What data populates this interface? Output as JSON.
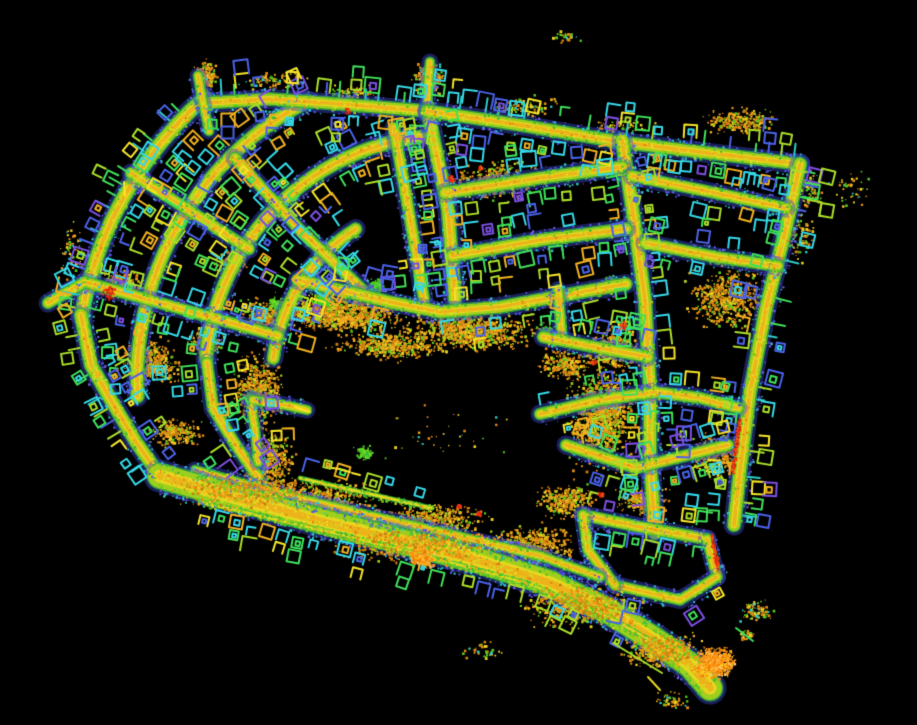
{
  "meta": {
    "label": "lidar-point-cloud-neighborhood-map",
    "width": 917,
    "height": 725,
    "background": "#000000",
    "seed": 1337
  },
  "palette": {
    "road": {
      "edge": "#3a46cc",
      "green": "#2fae3f",
      "mid": "#9ccf1e",
      "center": "#e6d81f",
      "hot": "#f0a418",
      "thin": [
        "#38b93c",
        "#aade28",
        "#e6d81f"
      ]
    },
    "speckle": {
      "edge": [
        "#4553d8",
        "#2fc8c8",
        "#6a5ae0"
      ],
      "mid": [
        "#38b93c",
        "#a8d21f",
        "#58c81e"
      ],
      "core": [
        "#e6d81f",
        "#f0b020",
        "#e08a14",
        "#cde01f",
        "#e6d81f",
        "#cde01f"
      ]
    },
    "houses": [
      [
        "#35d8e8",
        20
      ],
      [
        "#3fe05a",
        22
      ],
      [
        "#aade28",
        18
      ],
      [
        "#4a62e8",
        15
      ],
      [
        "#f0b020",
        12
      ],
      [
        "#f5e428",
        8
      ],
      [
        "#7a4fe0",
        5
      ]
    ],
    "ticks": [
      [
        "#3fe05a",
        30
      ],
      [
        "#2fc8c8",
        25
      ],
      [
        "#4a62e8",
        20
      ],
      [
        "#aade28",
        25
      ]
    ],
    "clusters": {
      "veg": [
        [
          "#e08a14",
          30
        ],
        [
          "#f5a81c",
          20
        ],
        [
          "#c27a10",
          14
        ],
        [
          "#f0d020",
          14
        ],
        [
          "#a8cc20",
          11
        ],
        [
          "#58c81e",
          11
        ]
      ],
      "blob": [
        [
          "#ff9414",
          30
        ],
        [
          "#ffae1c",
          25
        ],
        [
          "#f07c0a",
          25
        ],
        [
          "#ffd020",
          10
        ],
        [
          "#ffc96a",
          10
        ]
      ],
      "sparse": [
        [
          "#e08a14",
          30
        ],
        [
          "#f0d020",
          25
        ],
        [
          "#58c81e",
          25
        ],
        [
          "#2fc8c8",
          10
        ],
        [
          "#f5a81c",
          10
        ]
      ],
      "green": [
        [
          "#40d22a",
          30
        ],
        [
          "#58c81e",
          30
        ],
        [
          "#7de022",
          25
        ],
        [
          "#2fae3f",
          15
        ]
      ]
    },
    "red": [
      [
        "#e02810",
        35
      ],
      [
        "#ff3c14",
        30
      ],
      [
        "#c01c08",
        20
      ],
      [
        "#f06a10",
        15
      ]
    ],
    "mark_yellow": "#ffe428",
    "stray_colors": [
      "#aade28",
      "#e6d81f",
      "#3fe05a"
    ]
  },
  "map": {
    "arc_center": [
      450,
      380
    ],
    "arcs": [
      {
        "r": 374,
        "a0": -170,
        "a1": -131,
        "w": 13,
        "ticks": 1,
        "houses": 2
      },
      {
        "r": 313,
        "a0": -183,
        "a1": -117,
        "w": 12,
        "ticks": 0,
        "houses": 2
      },
      {
        "r": 245,
        "a0": -175,
        "a1": -95,
        "w": 12,
        "ticks": 0,
        "houses": 2
      },
      {
        "r": 178,
        "a0": -173,
        "a1": -120,
        "w": 11,
        "ticks": 0,
        "houses": 2
      }
    ],
    "streets": [
      {
        "pts": [
          [
            203,
            103
          ],
          [
            270,
            99
          ],
          [
            340,
            104
          ],
          [
            427,
            111
          ]
        ],
        "w": 11,
        "ticks": 1,
        "houses": 2
      },
      {
        "pts": [
          [
            209,
            131
          ],
          [
            202,
            98
          ],
          [
            198,
            76
          ]
        ],
        "w": 8,
        "houses": 0
      },
      {
        "pts": [
          [
            427,
            111
          ],
          [
            428,
            85
          ],
          [
            430,
            62
          ]
        ],
        "w": 8,
        "houses": 0
      },
      {
        "pts": [
          [
            81,
            315
          ],
          [
            91,
            365
          ],
          [
            112,
            402
          ],
          [
            136,
            442
          ],
          [
            160,
            476
          ]
        ],
        "w": 12,
        "ticks": -1,
        "houses": 2
      },
      {
        "pts": [
          [
            249,
            249
          ],
          [
            131,
            173
          ]
        ],
        "w": 10,
        "houses": 2
      },
      {
        "pts": [
          [
            365,
            292
          ],
          [
            300,
            230
          ],
          [
            235,
            158
          ]
        ],
        "w": 10,
        "houses": 2
      },
      {
        "pts": [
          [
            278,
            336
          ],
          [
            85,
            282
          ],
          [
            48,
            303
          ]
        ],
        "w": 10,
        "houses": 2
      },
      {
        "pts": [
          [
            207,
            363
          ],
          [
            213,
            408
          ],
          [
            235,
            444
          ],
          [
            258,
            477
          ]
        ],
        "w": 10,
        "houses": 2
      },
      {
        "pts": [
          [
            250,
            398
          ],
          [
            255,
            430
          ],
          [
            258,
            462
          ]
        ],
        "w": 8,
        "houses": 2
      },
      {
        "pts": [
          [
            253,
            400
          ],
          [
            280,
            404
          ],
          [
            307,
            410
          ]
        ],
        "w": 8,
        "houses": 0
      },
      {
        "pts": [
          [
            394,
            128
          ],
          [
            410,
            218
          ],
          [
            424,
            300
          ]
        ],
        "w": 10,
        "houses": 2
      },
      {
        "pts": [
          [
            428,
            112
          ],
          [
            448,
            210
          ],
          [
            455,
            300
          ]
        ],
        "w": 12,
        "houses": 2
      },
      {
        "pts": [
          [
            427,
            111
          ],
          [
            520,
            125
          ],
          [
            620,
            142
          ],
          [
            700,
            152
          ],
          [
            800,
            164
          ]
        ],
        "w": 11,
        "ticks": 1,
        "houses": 2
      },
      {
        "pts": [
          [
            800,
            164
          ],
          [
            786,
            228
          ],
          [
            766,
            308
          ],
          [
            750,
            392
          ],
          [
            740,
            470
          ],
          [
            734,
            525
          ]
        ],
        "w": 12,
        "ticks": 1,
        "houses": 2
      },
      {
        "pts": [
          [
            622,
            140
          ],
          [
            634,
            220
          ],
          [
            645,
            300
          ],
          [
            650,
            390
          ],
          [
            650,
            460
          ],
          [
            655,
            533
          ]
        ],
        "w": 12,
        "houses": 2
      },
      {
        "pts": [
          [
            445,
            193
          ],
          [
            540,
            178
          ],
          [
            622,
            167
          ]
        ],
        "w": 11,
        "houses": 2
      },
      {
        "pts": [
          [
            632,
            176
          ],
          [
            706,
            191
          ],
          [
            786,
            208
          ]
        ],
        "w": 10,
        "houses": 2
      },
      {
        "pts": [
          [
            452,
            256
          ],
          [
            540,
            240
          ],
          [
            626,
            229
          ]
        ],
        "w": 11,
        "houses": 2
      },
      {
        "pts": [
          [
            645,
            243
          ],
          [
            716,
            257
          ],
          [
            778,
            266
          ]
        ],
        "w": 10,
        "houses": 2
      },
      {
        "pts": [
          [
            298,
            280
          ],
          [
            340,
            290
          ],
          [
            390,
            302
          ],
          [
            440,
            312
          ],
          [
            500,
            307
          ],
          [
            560,
            296
          ],
          [
            626,
            284
          ]
        ],
        "w": 11,
        "houses": 2
      },
      {
        "pts": [
          [
            558,
            290
          ],
          [
            562,
            338
          ]
        ],
        "w": 9,
        "houses": 0
      },
      {
        "pts": [
          [
            543,
            337
          ],
          [
            600,
            348
          ],
          [
            648,
            357
          ]
        ],
        "w": 10,
        "houses": 1
      },
      {
        "pts": [
          [
            540,
            414
          ],
          [
            600,
            400
          ],
          [
            655,
            392
          ],
          [
            700,
            398
          ],
          [
            738,
            408
          ]
        ],
        "w": 10,
        "houses": 2
      },
      {
        "pts": [
          [
            566,
            445
          ],
          [
            636,
            468
          ],
          [
            700,
            452
          ],
          [
            728,
            445
          ]
        ],
        "w": 10,
        "houses": 2
      },
      {
        "pts": [
          [
            583,
            515
          ],
          [
            640,
            527
          ],
          [
            707,
            539
          ]
        ],
        "w": 10,
        "houses": 2
      },
      {
        "pts": [
          [
            707,
            539
          ],
          [
            717,
            577
          ]
        ],
        "w": 9,
        "houses": 0
      },
      {
        "pts": [
          [
            717,
            577
          ],
          [
            680,
            600
          ],
          [
            615,
            585
          ]
        ],
        "w": 9,
        "houses": 1
      },
      {
        "pts": [
          [
            615,
            585
          ],
          [
            588,
            550
          ],
          [
            583,
            515
          ]
        ],
        "w": 9,
        "houses": 0
      },
      {
        "pts": [
          [
            195,
            470
          ],
          [
            280,
            494
          ],
          [
            380,
            518
          ],
          [
            470,
            539
          ],
          [
            540,
            556
          ],
          [
            600,
            577
          ]
        ],
        "w": 8,
        "houses": 0
      },
      {
        "pts": [
          [
            160,
            476
          ],
          [
            240,
            499
          ],
          [
            320,
            521
          ],
          [
            400,
            541
          ],
          [
            480,
            561
          ],
          [
            550,
            583
          ],
          [
            610,
            612
          ],
          [
            655,
            640
          ],
          [
            690,
            665
          ],
          [
            710,
            688
          ]
        ],
        "w": 24,
        "houses": 0,
        "sp": 2.5
      },
      {
        "pts": [
          [
            200,
            502
          ],
          [
            265,
            517
          ],
          [
            330,
            532
          ],
          [
            395,
            548
          ],
          [
            460,
            565
          ],
          [
            530,
            584
          ],
          [
            590,
            610
          ]
        ],
        "w": 3,
        "houses": -1,
        "hd": 1.3
      },
      {
        "pts": [
          [
            560,
            595
          ],
          [
            610,
            618
          ],
          [
            650,
            640
          ],
          [
            680,
            658
          ]
        ],
        "w": 3,
        "houses": -1,
        "hd": 1.2
      },
      {
        "pts": [
          [
            300,
            478
          ],
          [
            370,
            494
          ],
          [
            432,
            508
          ]
        ],
        "w": 3,
        "houses": 1,
        "hd": 1.2
      }
    ],
    "clusters": [
      [
        340,
        313,
        72,
        22,
        1150
      ],
      [
        470,
        330,
        70,
        20,
        900
      ],
      [
        258,
        390,
        25,
        40,
        560
      ],
      [
        268,
        462,
        28,
        32,
        430
      ],
      [
        600,
        420,
        34,
        52,
        900
      ],
      [
        612,
        348,
        30,
        24,
        420
      ],
      [
        320,
        500,
        60,
        22,
        520
      ],
      [
        430,
        520,
        60,
        20,
        470
      ],
      [
        530,
        545,
        50,
        20,
        520
      ],
      [
        495,
        180,
        45,
        20,
        420
      ],
      [
        725,
        297,
        42,
        32,
        600
      ],
      [
        565,
        363,
        26,
        16,
        240
      ],
      [
        718,
        455,
        33,
        24,
        330
      ],
      [
        640,
        500,
        28,
        16,
        240
      ],
      [
        565,
        500,
        32,
        20,
        330
      ],
      [
        150,
        362,
        34,
        24,
        420
      ],
      [
        265,
        315,
        32,
        18,
        300
      ],
      [
        120,
        282,
        22,
        15,
        200
      ],
      [
        175,
        432,
        28,
        16,
        240
      ],
      [
        230,
        262,
        18,
        12,
        150
      ],
      [
        205,
        340,
        20,
        14,
        170
      ],
      [
        605,
        400,
        35,
        25,
        450
      ],
      [
        740,
        120,
        38,
        14,
        260
      ],
      [
        205,
        75,
        13,
        16,
        230
      ],
      [
        427,
        80,
        15,
        18,
        260
      ],
      [
        390,
        345,
        60,
        15,
        450,
        "veg",
        1
      ],
      [
        250,
        490,
        80,
        20,
        500,
        "veg",
        1
      ],
      [
        420,
        545,
        90,
        20,
        550,
        "veg",
        1
      ],
      [
        580,
        605,
        60,
        22,
        600,
        "veg",
        1
      ],
      [
        660,
        650,
        40,
        18,
        500,
        "veg",
        1
      ],
      [
        714,
        662,
        20,
        16,
        650,
        "blob",
        1
      ],
      [
        420,
        558,
        14,
        10,
        180,
        "blob",
        1
      ],
      [
        70,
        250,
        14,
        30,
        60,
        "sparse"
      ],
      [
        565,
        35,
        14,
        8,
        25,
        "sparse"
      ],
      [
        800,
        235,
        15,
        28,
        90,
        "sparse"
      ],
      [
        850,
        190,
        22,
        20,
        40,
        "sparse"
      ],
      [
        480,
        650,
        25,
        10,
        35,
        "sparse"
      ],
      [
        672,
        700,
        22,
        10,
        60,
        "sparse"
      ],
      [
        745,
        635,
        10,
        8,
        30,
        "sparse"
      ],
      [
        810,
        190,
        12,
        20,
        70,
        "sparse"
      ],
      [
        270,
        80,
        40,
        10,
        90,
        "sparse"
      ],
      [
        350,
        92,
        30,
        8,
        70,
        "sparse"
      ],
      [
        520,
        105,
        40,
        10,
        80,
        "sparse"
      ],
      [
        620,
        125,
        40,
        10,
        80,
        "sparse"
      ],
      [
        755,
        610,
        18,
        12,
        80,
        "sparse"
      ],
      [
        440,
        430,
        80,
        40,
        35,
        "sparse"
      ],
      [
        322,
        298,
        12,
        10,
        160,
        "green"
      ],
      [
        375,
        286,
        10,
        8,
        120,
        "green"
      ],
      [
        545,
        332,
        9,
        8,
        100,
        "green"
      ],
      [
        275,
        303,
        9,
        7,
        90,
        "green"
      ],
      [
        363,
        452,
        10,
        8,
        90,
        "green"
      ],
      [
        608,
        282,
        9,
        7,
        80,
        "green"
      ]
    ],
    "red_spots": [
      [
        108,
        292,
        9
      ],
      [
        347,
        110,
        4
      ],
      [
        450,
        178,
        4
      ],
      [
        480,
        167,
        3
      ],
      [
        622,
        325,
        5
      ],
      [
        593,
        362,
        4
      ],
      [
        600,
        494,
        4
      ],
      [
        458,
        506,
        3
      ],
      [
        478,
        513,
        3
      ]
    ],
    "red_lines": [
      [
        739,
        418,
        732,
        472
      ],
      [
        711,
        534,
        717,
        569
      ]
    ],
    "yellow_marks": [
      [
        332,
        468,
        340,
        469
      ],
      [
        342,
        470,
        350,
        472
      ],
      [
        352,
        473,
        360,
        475
      ],
      [
        295,
        407,
        310,
        412
      ],
      [
        124,
        182,
        125,
        196
      ]
    ],
    "stray_segments": [
      [
        613,
        643,
        662,
        673,
        0
      ],
      [
        648,
        677,
        660,
        690,
        1
      ],
      [
        736,
        628,
        753,
        641,
        2
      ]
    ]
  }
}
